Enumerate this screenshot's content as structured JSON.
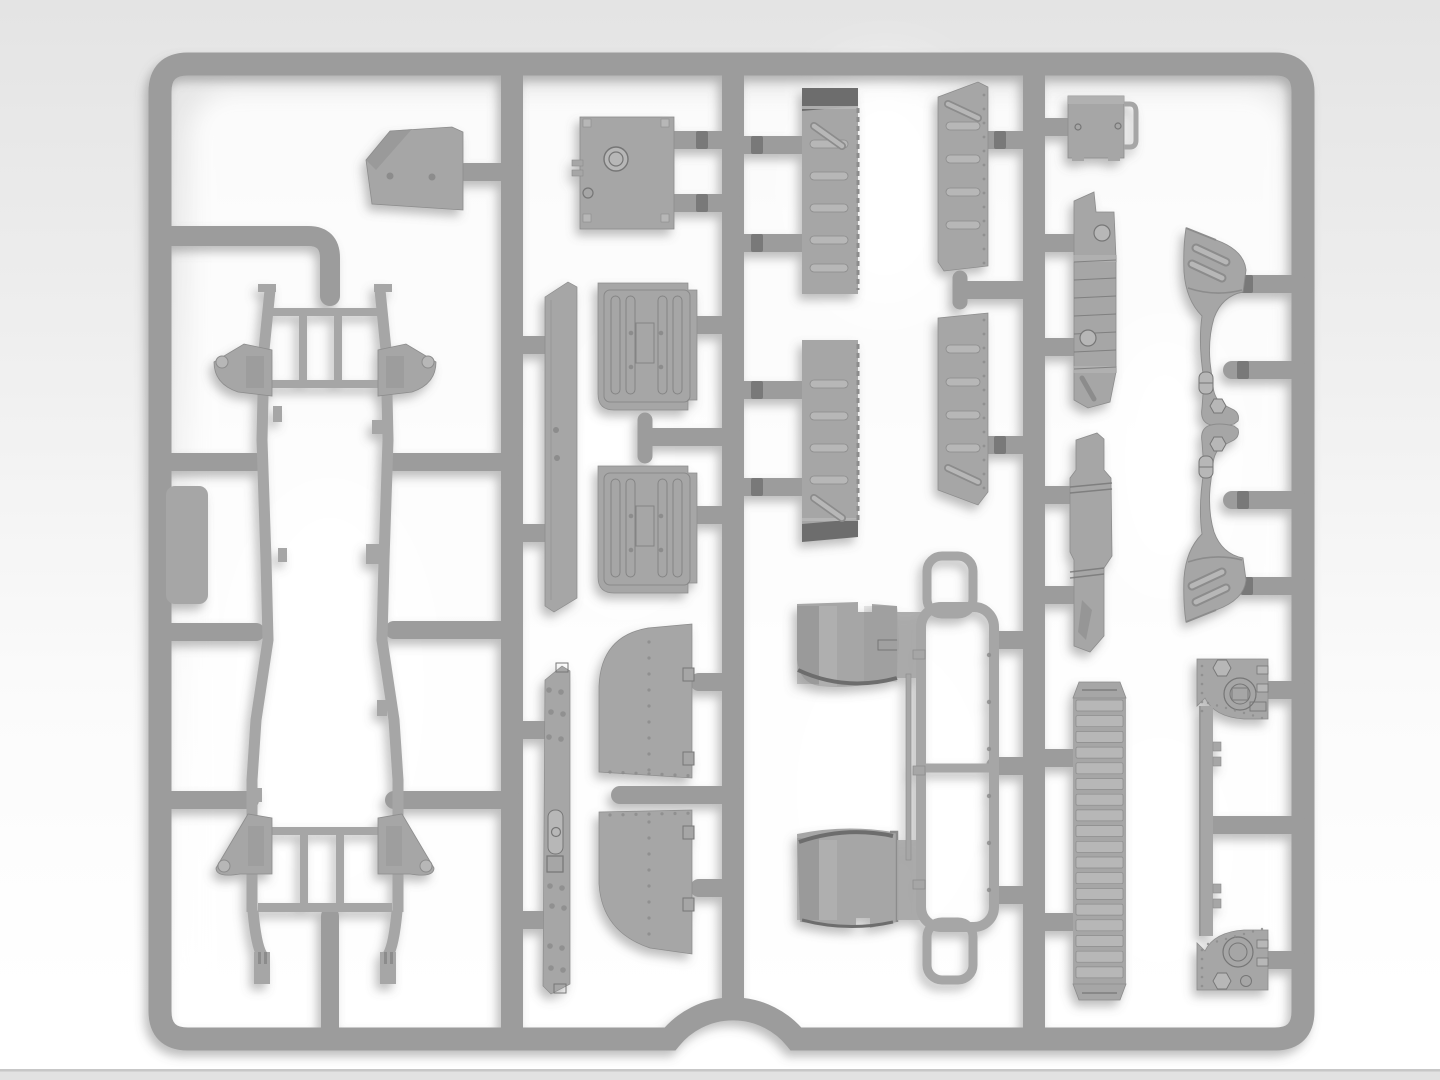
{
  "scene": {
    "subject": "injection-molded plastic model kit sprue with vehicle parts",
    "material": "gray styrene",
    "background": "light studio gradient"
  },
  "palette": {
    "bg_top": "#e4e4e4",
    "bg_mid": "#f0f0f0",
    "bg_low": "#fbfbfb",
    "bg_bottom": "#ffffff",
    "floor_strip": "#e2e2e2",
    "floor_line": "#c7c7c7",
    "glow": "#ffffff",
    "runner": "#9c9c9c",
    "runner_dark": "#878787",
    "part": "#a6a6a6",
    "part_light": "#b7b7b7",
    "part_dark": "#8c8c8c",
    "detail": "#767676",
    "cap_dark": "#6d6d6d",
    "gate": "#737373",
    "shadow": "#6f6f6f"
  },
  "sprue": {
    "frame_path": "M 190 64 H 1275 Q 1303 64 1303 92 V 1011 Q 1303 1039 1275 1039 H 796 A 81 81 0 0 0 670 1039 H 188 Q 160 1039 160 1011 V 92 Q 160 64 188 64 Z",
    "frame_stroke": 23,
    "dividers": [
      {
        "name": "divider-1",
        "d": "M 512 64 V 1039"
      },
      {
        "name": "divider-2",
        "d": "M 733 64 V 1000"
      },
      {
        "name": "divider-3",
        "d": "M 1034 64 V 1039"
      }
    ],
    "elbow_path": "M 160 236 H 308 Q 330 236 330 258 V 296",
    "chassis_drop_path": "M 330 916 V 1036",
    "stubs": [
      [
        160,
        462,
        256,
        462
      ],
      [
        160,
        632,
        256,
        632
      ],
      [
        160,
        800,
        250,
        800
      ],
      [
        394,
        462,
        512,
        462
      ],
      [
        394,
        630,
        512,
        630
      ],
      [
        394,
        800,
        512,
        800
      ],
      [
        465,
        172,
        512,
        172
      ],
      [
        512,
        345,
        545,
        345
      ],
      [
        512,
        533,
        545,
        533
      ],
      [
        512,
        730,
        545,
        730
      ],
      [
        512,
        920,
        545,
        920
      ],
      [
        673,
        140,
        733,
        140
      ],
      [
        673,
        203,
        733,
        203
      ],
      [
        697,
        325,
        733,
        325
      ],
      [
        697,
        515,
        733,
        515
      ],
      [
        648,
        437,
        733,
        437
      ],
      [
        699,
        682,
        733,
        682
      ],
      [
        620,
        795,
        733,
        795
      ],
      [
        699,
        888,
        733,
        888
      ],
      [
        733,
        145,
        803,
        145
      ],
      [
        733,
        243,
        803,
        243
      ],
      [
        733,
        390,
        803,
        390
      ],
      [
        733,
        487,
        803,
        487
      ],
      [
        988,
        140,
        1034,
        140
      ],
      [
        967,
        290,
        1034,
        290
      ],
      [
        988,
        445,
        1034,
        445
      ],
      [
        998,
        640,
        1034,
        640
      ],
      [
        995,
        766,
        1034,
        766
      ],
      [
        998,
        895,
        1034,
        895
      ],
      [
        1034,
        127,
        1069,
        127
      ],
      [
        1034,
        243,
        1074,
        243
      ],
      [
        1034,
        347,
        1074,
        347
      ],
      [
        1034,
        495,
        1074,
        495
      ],
      [
        1034,
        595,
        1074,
        595
      ],
      [
        1034,
        758,
        1074,
        758
      ],
      [
        1034,
        922,
        1074,
        922
      ],
      [
        1213,
        825,
        1298,
        825
      ],
      [
        1268,
        690,
        1298,
        690
      ],
      [
        1268,
        960,
        1298,
        960
      ],
      [
        1243,
        284,
        1298,
        284
      ],
      [
        1232,
        370,
        1298,
        370
      ],
      [
        1232,
        500,
        1298,
        500
      ],
      [
        1243,
        586,
        1298,
        586
      ]
    ],
    "tee_bars": [
      [
        645,
        420,
        645,
        456
      ],
      [
        960,
        278,
        960,
        302
      ]
    ],
    "gates": [
      [
        702,
        140
      ],
      [
        702,
        203
      ],
      [
        757,
        145
      ],
      [
        757,
        243
      ],
      [
        757,
        390
      ],
      [
        757,
        487
      ],
      [
        1000,
        140
      ],
      [
        1000,
        445
      ],
      [
        1247,
        284
      ],
      [
        1243,
        370
      ],
      [
        1243,
        500
      ],
      [
        1247,
        586
      ]
    ]
  },
  "generated": {
    "grille_slats": {
      "x": 1076,
      "y": 700,
      "w": 47,
      "h": 11,
      "step": 15.7,
      "n": 18
    },
    "rib_rows": [
      [
        810,
        140,
        38,
        8
      ],
      [
        810,
        172,
        38,
        8
      ],
      [
        810,
        204,
        38,
        8
      ],
      [
        810,
        236,
        38,
        8
      ],
      [
        810,
        264,
        38,
        8
      ],
      [
        810,
        380,
        38,
        8
      ],
      [
        810,
        412,
        38,
        8
      ],
      [
        810,
        444,
        38,
        8
      ],
      [
        810,
        476,
        38,
        8
      ],
      [
        946,
        122,
        34,
        8
      ],
      [
        946,
        155,
        34,
        8
      ],
      [
        946,
        188,
        34,
        8
      ],
      [
        946,
        221,
        34,
        8
      ],
      [
        946,
        345,
        34,
        8
      ],
      [
        946,
        378,
        34,
        8
      ],
      [
        946,
        411,
        34,
        8
      ],
      [
        946,
        444,
        34,
        8
      ]
    ],
    "diag_ribs": [
      [
        814,
        126,
        842,
        146
      ],
      [
        814,
        498,
        842,
        518
      ],
      [
        948,
        104,
        978,
        118
      ],
      [
        948,
        468,
        978,
        482
      ]
    ],
    "dot_rows": [
      {
        "x": 649,
        "y": 642,
        "dx": 0,
        "dy": 16,
        "n": 9,
        "r": 1.6
      },
      {
        "x": 610,
        "y": 772,
        "dx": 13,
        "dy": 0.6,
        "n": 7,
        "r": 1.6
      },
      {
        "x": 649,
        "y": 822,
        "dx": 0,
        "dy": 16,
        "n": 8,
        "r": 1.6
      },
      {
        "x": 610,
        "y": 815,
        "dx": 13,
        "dy": -0.3,
        "n": 7,
        "r": 1.6
      },
      {
        "x": 984,
        "y": 95,
        "dx": 0,
        "dy": 14,
        "n": 13,
        "r": 1.4
      },
      {
        "x": 984,
        "y": 320,
        "dx": 0,
        "dy": 14,
        "n": 13,
        "r": 1.4
      },
      {
        "x": 989,
        "y": 655,
        "dx": 0,
        "dy": 47,
        "n": 6,
        "r": 2.2
      },
      {
        "x": 1202,
        "y": 666,
        "dx": 0,
        "dy": 9,
        "n": 6,
        "r": 1.3
      },
      {
        "x": 1208,
        "y": 703,
        "dx": 9,
        "dy": 2.5,
        "n": 7,
        "r": 1.2
      },
      {
        "x": 1202,
        "y": 950,
        "dx": 0,
        "dy": 9,
        "n": 5,
        "r": 1.3
      },
      {
        "x": 1208,
        "y": 944,
        "dx": 9,
        "dy": -2.5,
        "n": 7,
        "r": 1.2
      },
      {
        "x": 549,
        "y": 690,
        "dx": 12,
        "dy": 2,
        "n": 2,
        "r": 2.8
      },
      {
        "x": 551,
        "y": 712,
        "dx": 12,
        "dy": 2,
        "n": 2,
        "r": 2.8
      },
      {
        "x": 549,
        "y": 737,
        "dx": 12,
        "dy": 2,
        "n": 2,
        "r": 2.8
      },
      {
        "x": 550,
        "y": 886,
        "dx": 12,
        "dy": 2,
        "n": 2,
        "r": 2.8
      },
      {
        "x": 552,
        "y": 906,
        "dx": 12,
        "dy": 2,
        "n": 2,
        "r": 2.8
      },
      {
        "x": 550,
        "y": 946,
        "dx": 12,
        "dy": 2,
        "n": 2,
        "r": 2.8
      },
      {
        "x": 551,
        "y": 968,
        "dx": 12,
        "dy": 2,
        "n": 2,
        "r": 2.8
      }
    ],
    "seat_panels_y": [
      283,
      466
    ]
  },
  "parts": [
    {
      "name": "chassis-ladder-frame",
      "bbox": [
        214,
        285,
        222,
        700
      ]
    },
    {
      "name": "side-step-plate",
      "bbox": [
        166,
        486,
        42,
        118
      ]
    },
    {
      "name": "cab-rear-wedge-panel",
      "bbox": [
        366,
        127,
        97,
        87
      ]
    },
    {
      "name": "radiator-assembly",
      "bbox": [
        580,
        117,
        94,
        112
      ]
    },
    {
      "name": "running-board-1",
      "bbox": [
        545,
        282,
        32,
        330
      ]
    },
    {
      "name": "seat-cushion-1",
      "bbox": [
        598,
        283,
        100,
        127
      ]
    },
    {
      "name": "seat-cushion-2",
      "bbox": [
        598,
        466,
        100,
        127
      ]
    },
    {
      "name": "running-board-2",
      "bbox": [
        543,
        666,
        27,
        328
      ]
    },
    {
      "name": "door-card-1",
      "bbox": [
        599,
        624,
        93,
        154
      ]
    },
    {
      "name": "door-card-2",
      "bbox": [
        599,
        810,
        93,
        144
      ]
    },
    {
      "name": "bed-side-panel-1",
      "bbox": [
        802,
        88,
        56,
        206
      ]
    },
    {
      "name": "bed-side-panel-2",
      "bbox": [
        802,
        340,
        56,
        200
      ]
    },
    {
      "name": "bed-front-panel-1",
      "bbox": [
        938,
        82,
        50,
        190
      ]
    },
    {
      "name": "bed-front-panel-2",
      "bbox": [
        938,
        313,
        50,
        192
      ]
    },
    {
      "name": "seat-backrest-1",
      "bbox": [
        797,
        602,
        103,
        88
      ]
    },
    {
      "name": "seat-backrest-2",
      "bbox": [
        797,
        824,
        100,
        104
      ]
    },
    {
      "name": "windshield-roll-frame",
      "bbox": [
        921,
        555,
        74,
        425
      ]
    },
    {
      "name": "wiper-rod",
      "bbox": [
        906,
        674,
        5,
        186
      ]
    },
    {
      "name": "stowage-box",
      "bbox": [
        1068,
        96,
        68,
        62
      ]
    },
    {
      "name": "muffler",
      "bbox": [
        1073,
        192,
        43,
        216
      ]
    },
    {
      "name": "suspension-bracket",
      "bbox": [
        1070,
        433,
        42,
        220
      ]
    },
    {
      "name": "grille-louver-panel",
      "bbox": [
        1073,
        682,
        53,
        318
      ]
    },
    {
      "name": "bulkhead-panel",
      "bbox": [
        1197,
        659,
        71,
        331
      ]
    },
    {
      "name": "front-fender-1",
      "bbox": [
        1183,
        228,
        64,
        200
      ]
    },
    {
      "name": "front-fender-2",
      "bbox": [
        1183,
        426,
        64,
        196
      ]
    }
  ]
}
